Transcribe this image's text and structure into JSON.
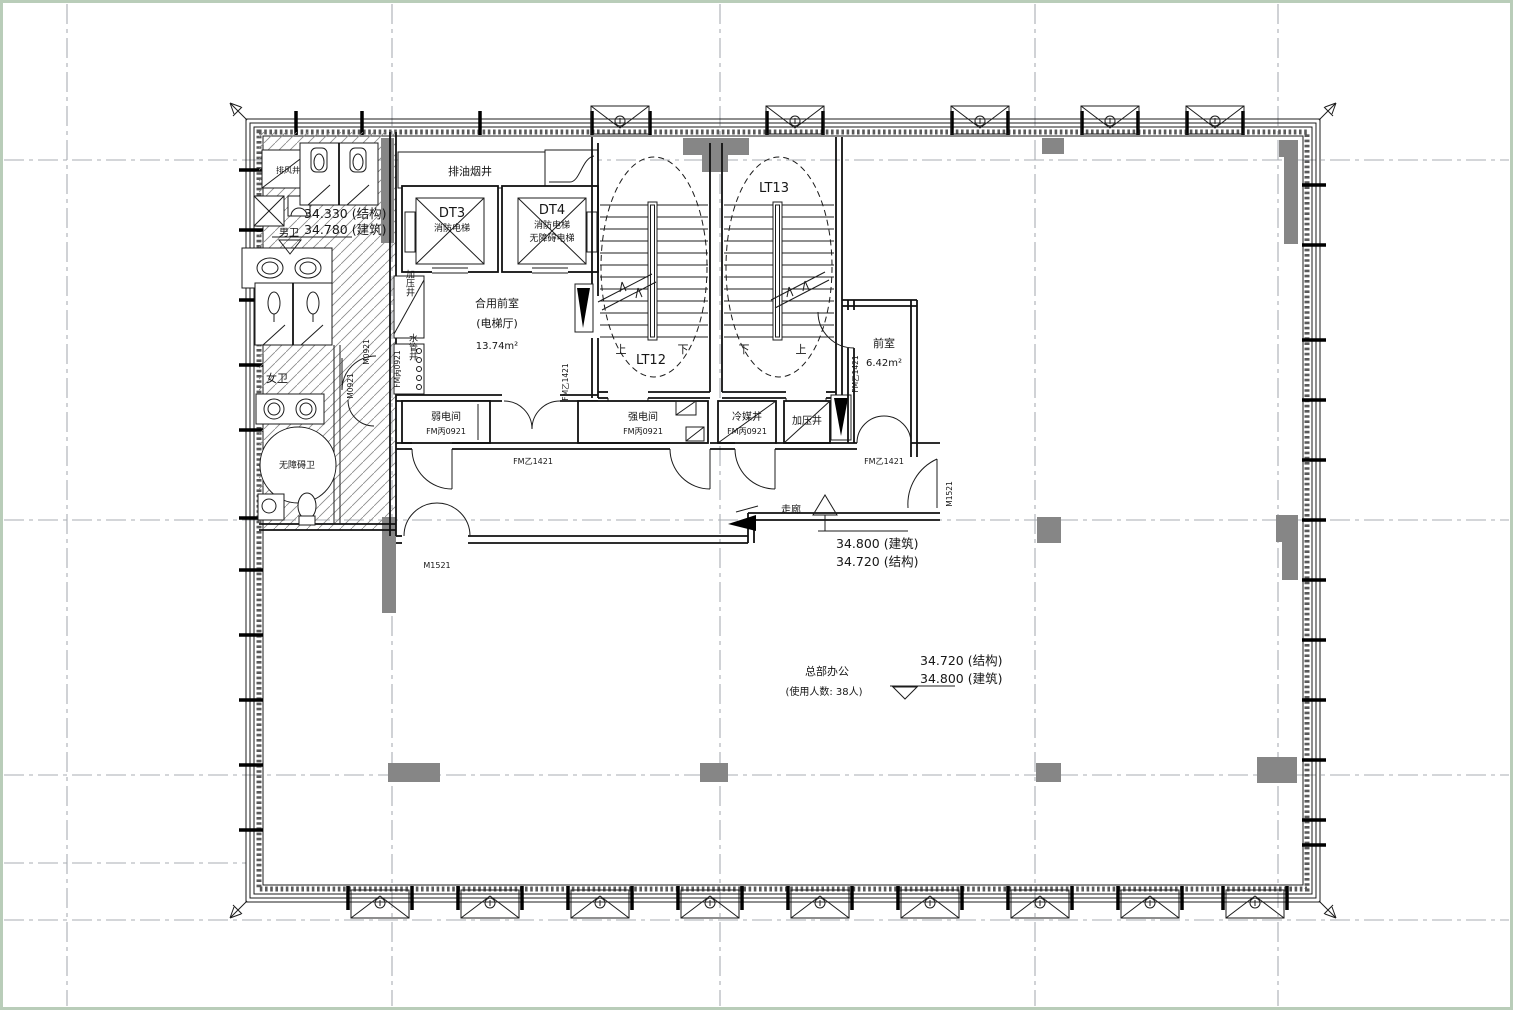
{
  "plan": {
    "shafts": {
      "exhaust": "排风井",
      "grease": "排油烟井",
      "pressure": "加压井",
      "water": "水管井",
      "refrigerant": "冷媒井"
    },
    "elevators": {
      "dt3": {
        "id": "DT3",
        "type": "消防电梯"
      },
      "dt4": {
        "id": "DT4",
        "type1": "消防电梯",
        "type2": "无障碍电梯"
      }
    },
    "stairs": {
      "lt12": "LT12",
      "lt13": "LT13",
      "up": "上",
      "down": "下"
    },
    "rooms": {
      "lobby": {
        "name": "合用前室",
        "alias": "(电梯厅)",
        "area": "13.74m²"
      },
      "anteroom": {
        "name": "前室",
        "area": "6.42m²"
      },
      "weak": {
        "name": "弱电间"
      },
      "strong": {
        "name": "强电间"
      },
      "mens": "男卫",
      "womens": "女卫",
      "accessible": "无障碍卫",
      "corridor": "走廊",
      "office": {
        "name": "总部办公",
        "occupancy": "(使用人数: 38人)"
      }
    },
    "doors": {
      "fm_b1421": "FM乙1421",
      "fm_c0921": "FM丙0921",
      "m1521": "M1521",
      "m0921": "M0921"
    },
    "levels": {
      "wc": {
        "struct": "34.330 (结构)",
        "arch": "34.780 (建筑)"
      },
      "corridor": {
        "arch": "34.800 (建筑)",
        "struct": "34.720 (结构)"
      },
      "office": {
        "struct": "34.720 (结构)",
        "arch": "34.800 (建筑)"
      }
    },
    "colors": {
      "wall": "#1c1c1c",
      "grey_fill": "#868686",
      "grid": "#a9adb3",
      "frame": "#b9cdb9"
    }
  }
}
